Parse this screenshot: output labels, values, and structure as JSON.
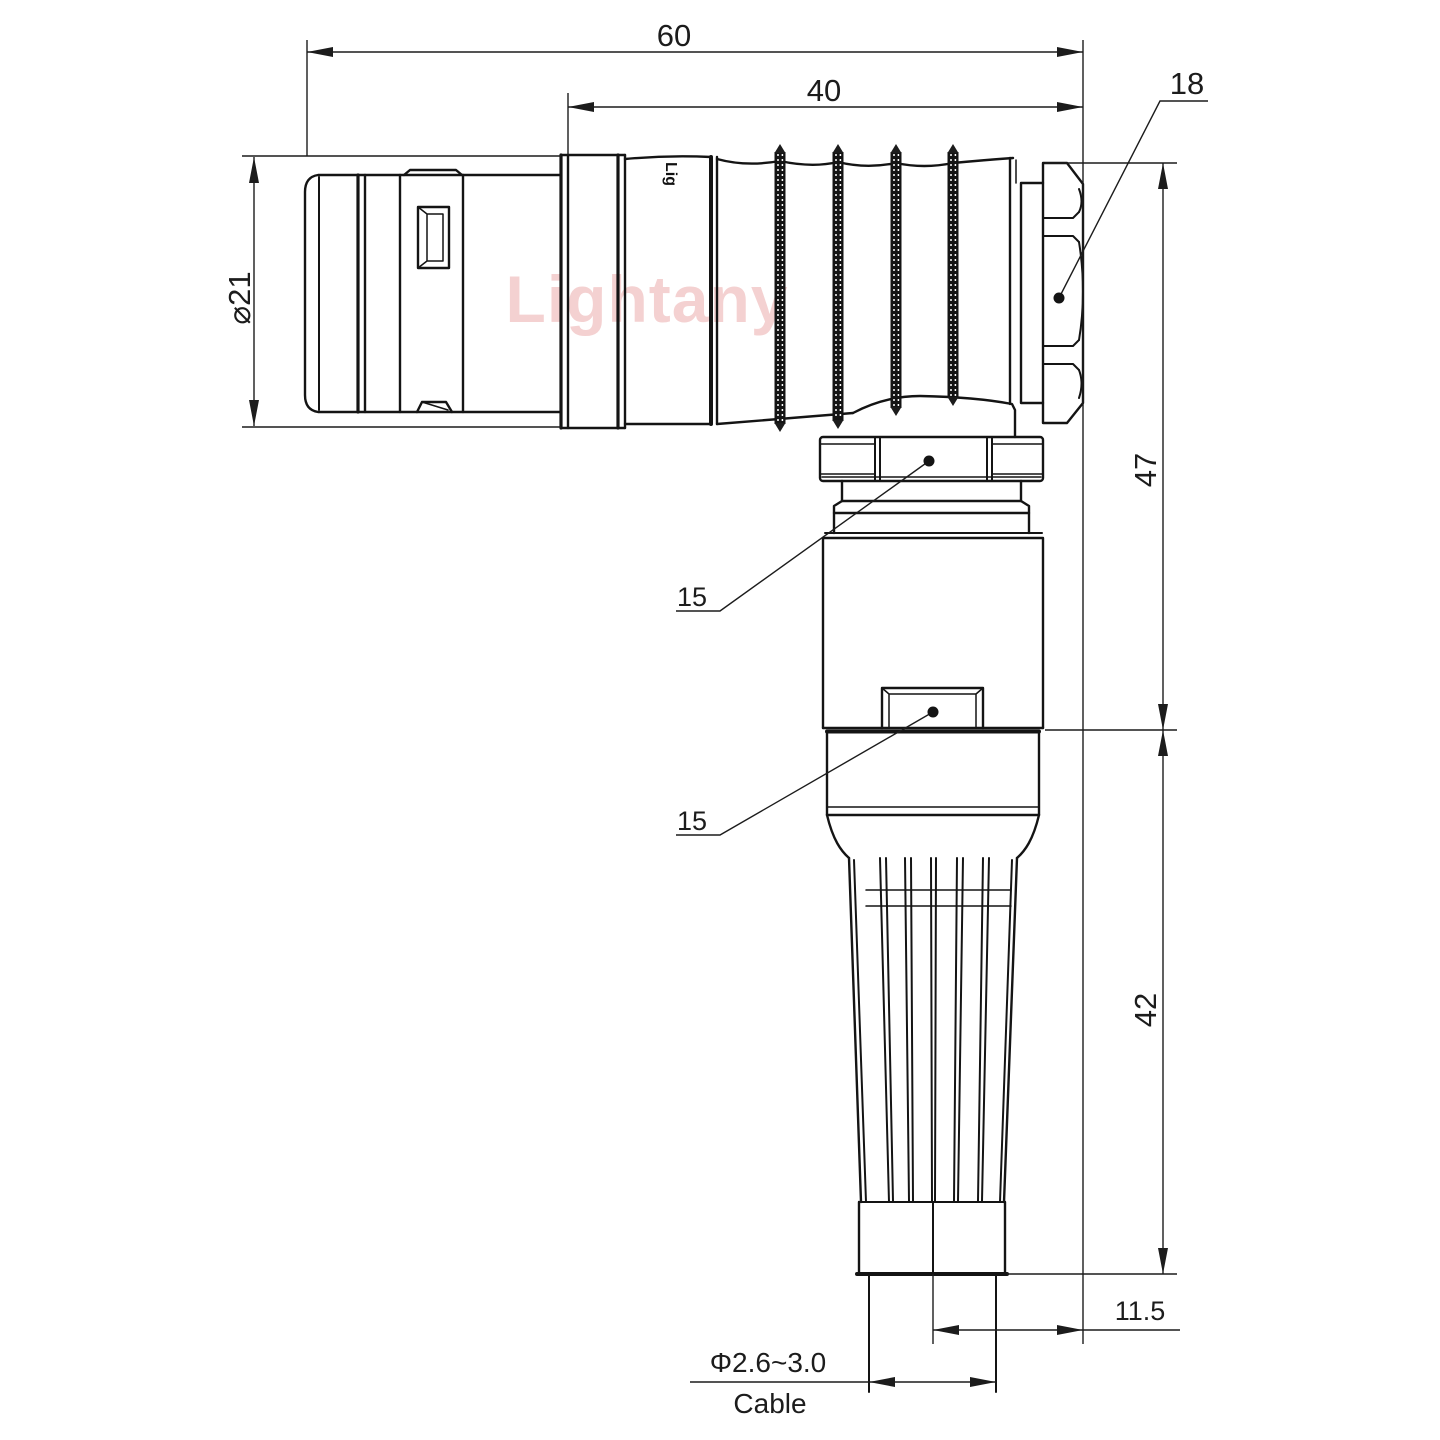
{
  "watermark": {
    "text": "Lightany"
  },
  "part_marking": {
    "text": "Lig"
  },
  "dimensions": {
    "overall_length": "60",
    "rear_length": "40",
    "nut_across": "18",
    "front_diameter": "⌀21",
    "height_upper": "47",
    "height_lower": "42",
    "coupling_nut": "15",
    "body_flat": "15",
    "offset": "11.5",
    "cable_diameter": "Φ2.6~3.0",
    "cable_label": "Cable"
  }
}
